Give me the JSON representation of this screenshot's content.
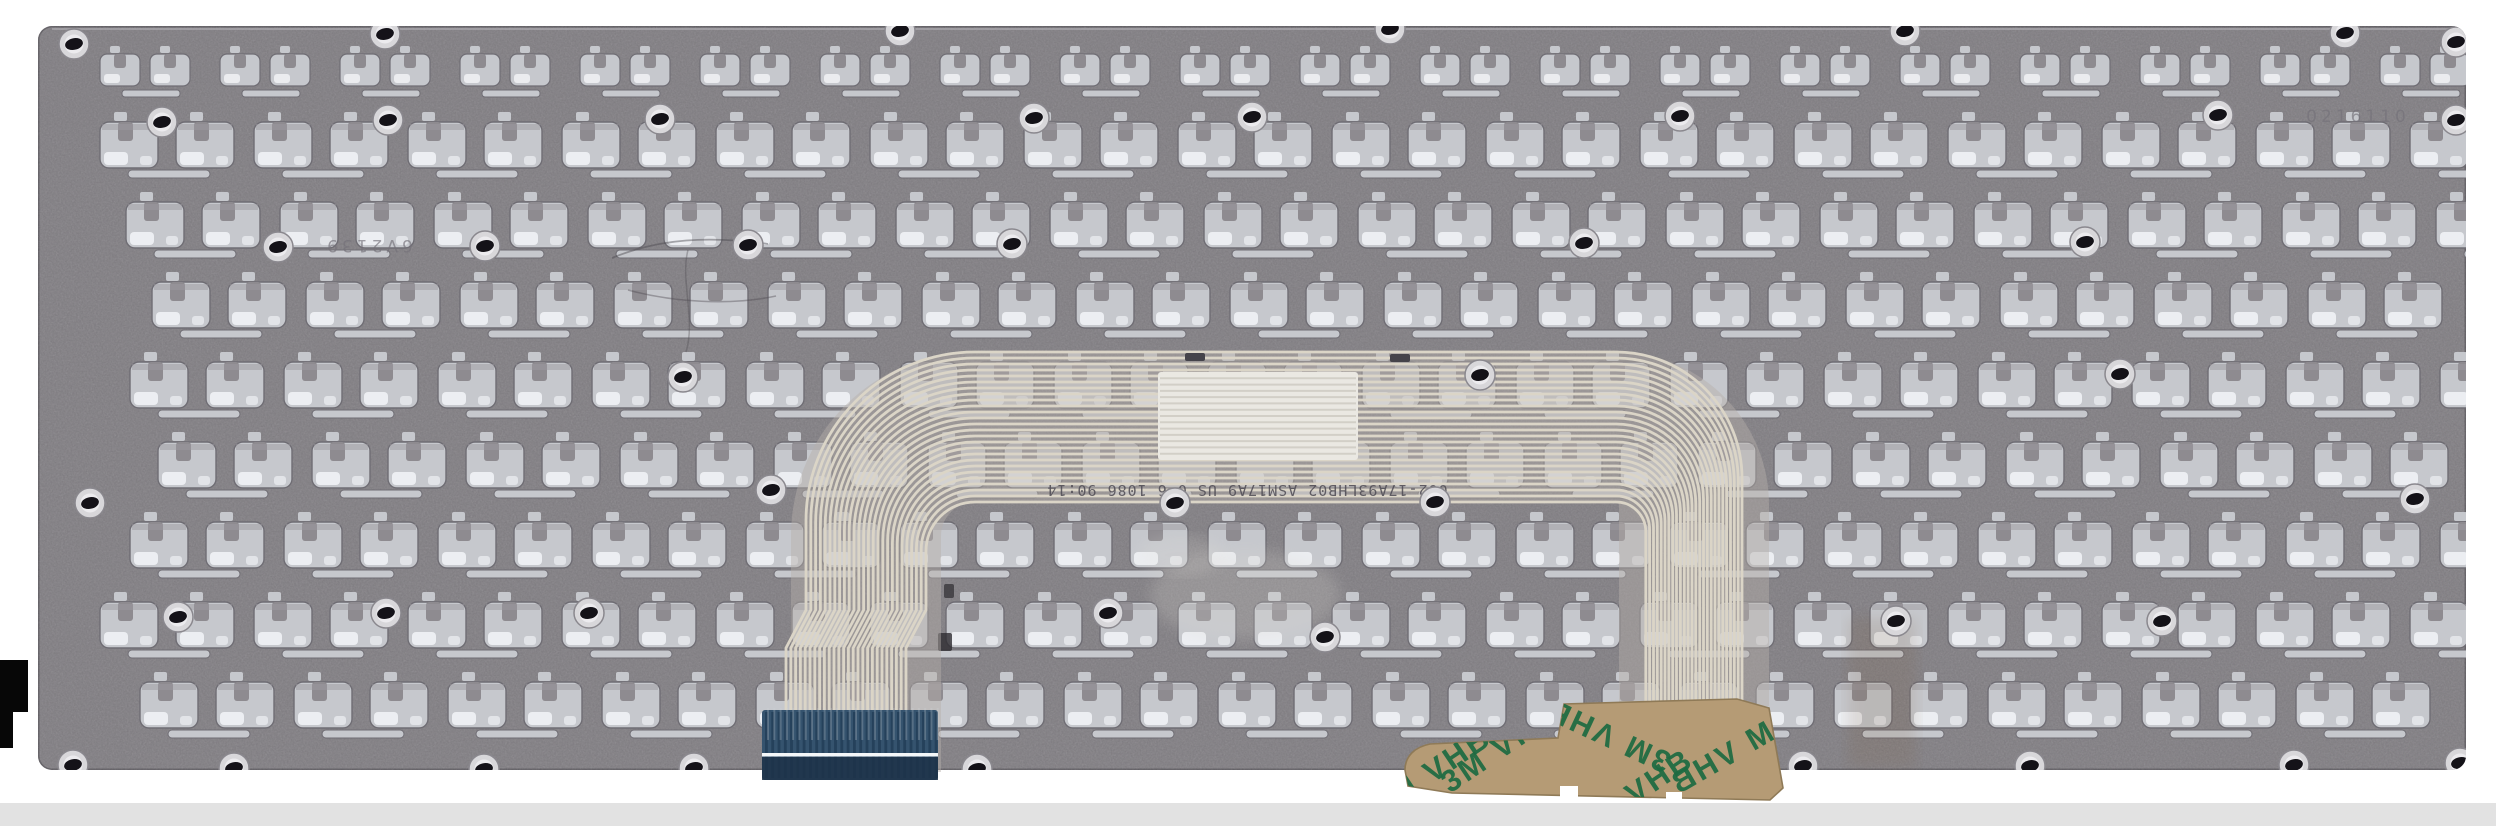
{
  "scene": {
    "description": "Rear metal backplate of a laptop keyboard with printed flex ribbon cable, blue FPC connector tail and 3M VHB adhesive tape, photographed on white",
    "background": "#ffffff",
    "bottom_strip_color": "#e2e2e2"
  },
  "colors": {
    "plate": "#8e8b90",
    "plateEdge": "#6a676d",
    "cut": "#c6c8cd",
    "cutStroke": "#6f6d74",
    "hl": "#eef0f3",
    "trace": "#dbd5c7",
    "underlay": "#b5b0ab",
    "label": "#eae8e2",
    "labelLine": "#d2cfc7",
    "connBase": "#35536e",
    "connStripe": "#243f59",
    "connLower": "#1d3349",
    "connWhiteLine": "#f4f7f9",
    "tape": "#b59b75",
    "tapeEdge": "#8f7a57",
    "tapePrint": "#1d6b42",
    "holeBlack": "#141218",
    "holeRing": "#d8d7da",
    "holeInner": "#ecebee",
    "strip": "#e2e2e2",
    "artifact": "#070707",
    "stamp": "#747179",
    "marking": "#4e4b54"
  },
  "plate": {
    "x": 38,
    "y": 26,
    "width": 2428,
    "height": 744,
    "corner_radius": 14,
    "stamps": [
      {
        "text": "6V2139",
        "x": 368,
        "y": 252,
        "rotated": true
      },
      {
        "text": "0216110",
        "x": 2358,
        "y": 122,
        "rotated": false
      }
    ],
    "rows": [
      {
        "y": 46,
        "h": 56,
        "tile": "s",
        "offset": 0
      },
      {
        "y": 112,
        "h": 66,
        "tile": "b",
        "offset": 0
      },
      {
        "y": 192,
        "h": 66,
        "tile": "b",
        "offset": 26
      },
      {
        "y": 272,
        "h": 66,
        "tile": "b",
        "offset": 52
      },
      {
        "y": 352,
        "h": 66,
        "tile": "b",
        "offset": 30
      },
      {
        "y": 432,
        "h": 66,
        "tile": "b",
        "offset": 58
      },
      {
        "y": 512,
        "h": 66,
        "tile": "b",
        "offset": 30
      },
      {
        "y": 592,
        "h": 66,
        "tile": "b",
        "offset": 0
      },
      {
        "y": 672,
        "h": 66,
        "tile": "b",
        "offset": 40
      }
    ],
    "holes": [
      [
        74,
        44
      ],
      [
        385,
        34
      ],
      [
        900,
        31
      ],
      [
        1390,
        29
      ],
      [
        1905,
        31
      ],
      [
        2345,
        33
      ],
      [
        2456,
        42
      ],
      [
        162,
        122
      ],
      [
        388,
        120
      ],
      [
        660,
        119
      ],
      [
        1034,
        118
      ],
      [
        1252,
        117
      ],
      [
        1680,
        116
      ],
      [
        2218,
        115
      ],
      [
        2456,
        120
      ],
      [
        278,
        247
      ],
      [
        485,
        246
      ],
      [
        748,
        245
      ],
      [
        1012,
        244
      ],
      [
        1584,
        243
      ],
      [
        2085,
        242
      ],
      [
        683,
        377
      ],
      [
        1480,
        375
      ],
      [
        2120,
        374
      ],
      [
        90,
        503
      ],
      [
        771,
        490
      ],
      [
        1175,
        503
      ],
      [
        1435,
        502
      ],
      [
        2415,
        499
      ],
      [
        178,
        617
      ],
      [
        386,
        613
      ],
      [
        589,
        613
      ],
      [
        1108,
        613
      ],
      [
        1325,
        637
      ],
      [
        1896,
        621
      ],
      [
        2162,
        621
      ],
      [
        73,
        765
      ],
      [
        234,
        768
      ],
      [
        484,
        769
      ],
      [
        694,
        768
      ],
      [
        977,
        769
      ],
      [
        1803,
        766
      ],
      [
        2030,
        766
      ],
      [
        2294,
        765
      ],
      [
        2460,
        763
      ]
    ]
  },
  "ribbon": {
    "marking": "002-17A93LHB02   ASM17A9 US 0 6 1086   90:14",
    "geometry": {
      "n": 26,
      "x0": 806,
      "dx": 4.8,
      "y0": 352,
      "dy": 6,
      "left_land": 975,
      "right_start": 1616,
      "r0": 126,
      "dr": 3.85,
      "jog_top": 610,
      "jog_bottom": 648,
      "jog_shift": 20
    },
    "label_rect": {
      "x": 1158,
      "y": 372,
      "w": 200,
      "h": 88,
      "stripes": 13
    }
  },
  "connector": {
    "x": 762,
    "y": 710,
    "w": 176,
    "h": 70,
    "white_line_y": 753,
    "pins": 28
  },
  "tape": {
    "print_text": "3M VHB",
    "print_instances": [
      {
        "x": 1438,
        "y": 780,
        "rot": -34,
        "mirror": false
      },
      {
        "x": 1612,
        "y": 726,
        "rot": 205,
        "mirror": false
      },
      {
        "x": 1735,
        "y": 762,
        "rot": -30,
        "mirror": true
      },
      {
        "x": 1640,
        "y": 802,
        "rot": -34,
        "mirror": false
      },
      {
        "x": 1506,
        "y": 756,
        "rot": -34,
        "mirror": false
      }
    ]
  }
}
